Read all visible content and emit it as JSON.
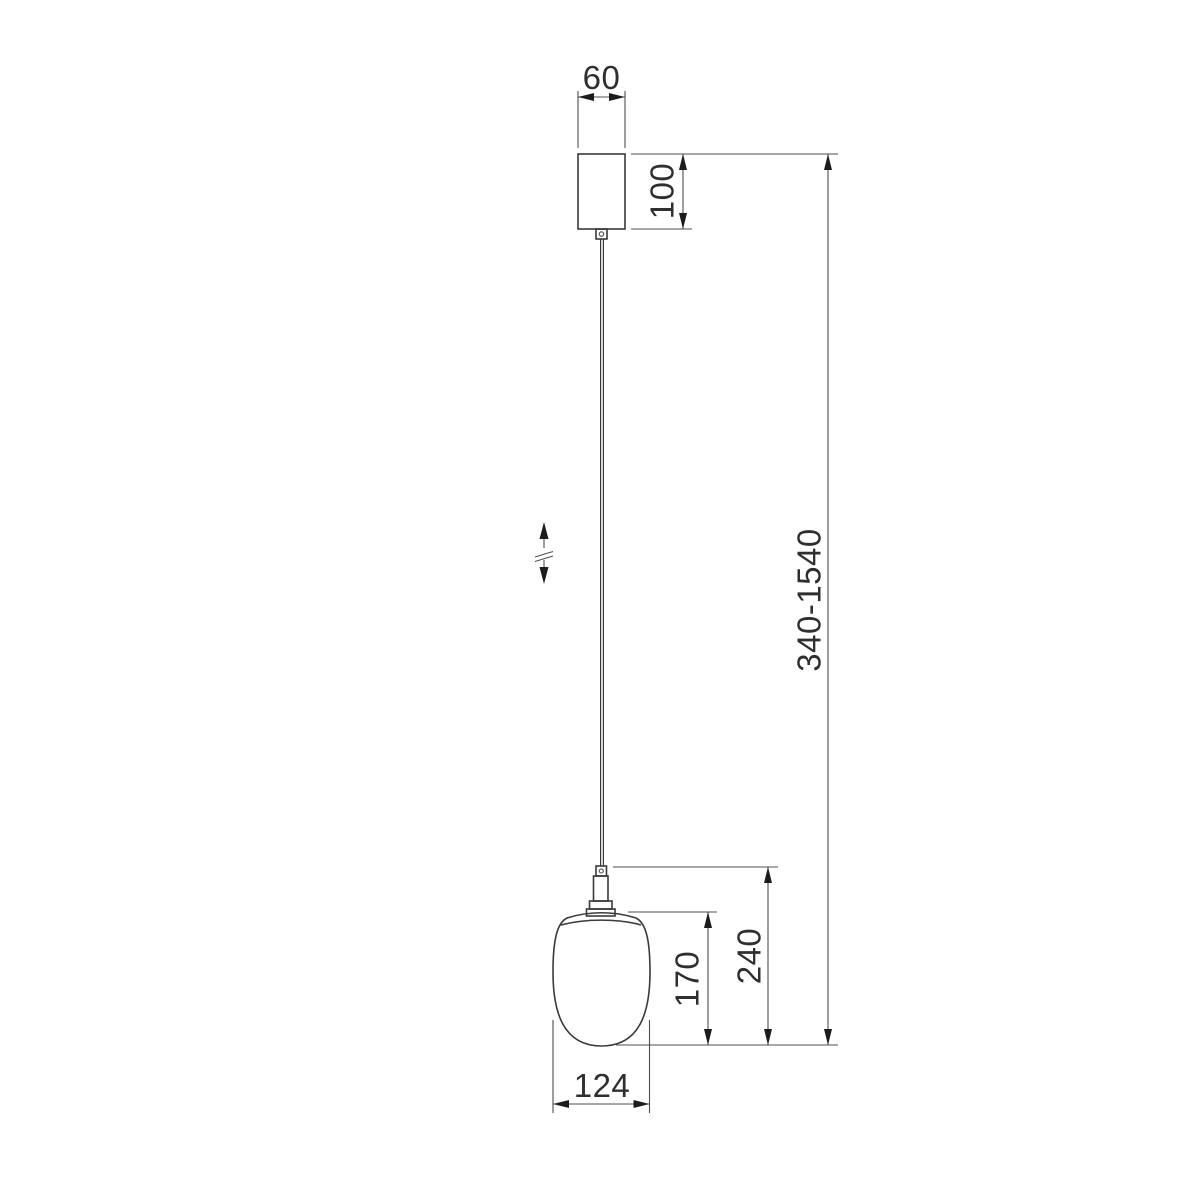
{
  "drawing": {
    "type": "technical-dimension-drawing",
    "subject": "pendant-lamp",
    "colors": {
      "background": "#ffffff",
      "object_line": "#3a3a3a",
      "dimension_line": "#4f4f4f",
      "arrow": "#1c1c1c",
      "text": "#2f2f2f"
    },
    "dimensions": {
      "canopy_width": {
        "label": "60"
      },
      "canopy_height": {
        "label": "100"
      },
      "overall_height": {
        "label": "340-1540"
      },
      "body_height": {
        "label": "240"
      },
      "shade_height": {
        "label": "170"
      },
      "shade_width": {
        "label": "124"
      }
    }
  }
}
